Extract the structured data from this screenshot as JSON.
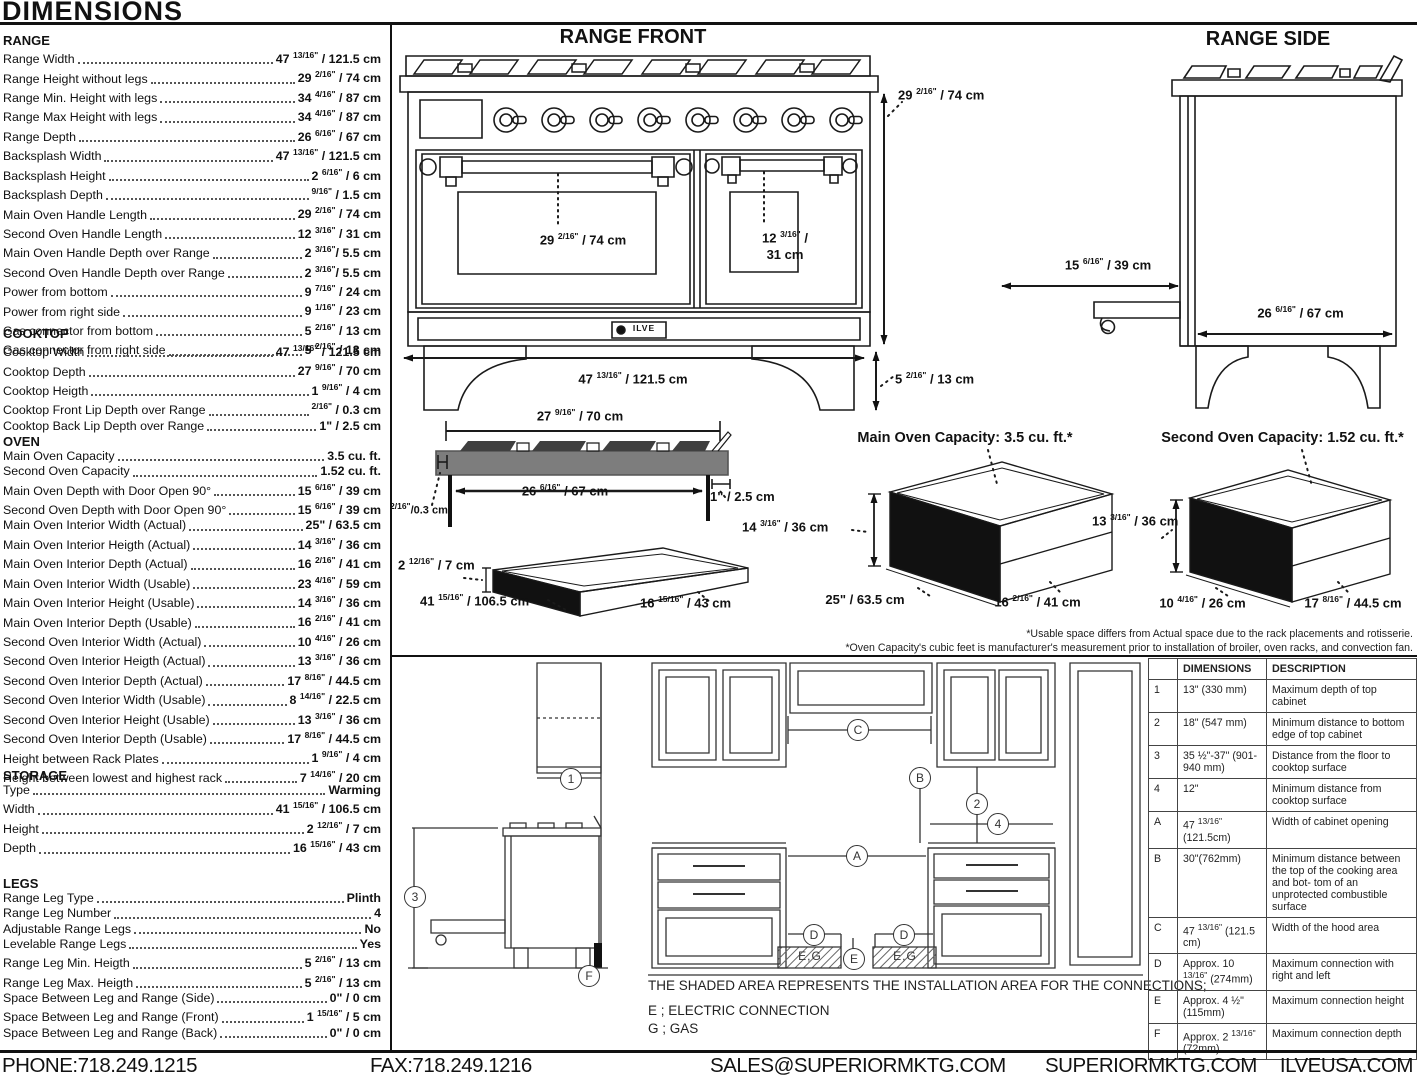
{
  "page": {
    "title": "DIMENSIONS",
    "footer": {
      "phone": "PHONE:718.249.1215",
      "fax": "FAX:718.249.1216",
      "email": "SALES@SUPERIORMKTG.COM",
      "site": "SUPERIORMKTG.COM",
      "brand_site": "ILVEUSA.COM"
    }
  },
  "specs": {
    "sections": [
      {
        "name": "RANGE",
        "rows": [
          {
            "label": "Range Width",
            "value": "47 13/16\" / 121.5 cm"
          },
          {
            "label": "Range Height without legs",
            "value": "29 2/16\" / 74 cm"
          },
          {
            "label": "Range Min. Height with legs",
            "value": "34 4/16\" / 87 cm"
          },
          {
            "label": "Range Max Height with legs",
            "value": "34 4/16\" / 87 cm"
          },
          {
            "label": "Range Depth",
            "value": "26 6/16\" / 67 cm"
          },
          {
            "label": "Backsplash Width",
            "value": "47 13/16\" / 121.5 cm"
          },
          {
            "label": "Backsplash Height",
            "value": "2 6/16\" / 6 cm"
          },
          {
            "label": "Backsplash Depth",
            "value": "9/16\" / 1.5 cm"
          },
          {
            "label": "Main Oven Handle Length",
            "value": "29 2/16\" / 74 cm"
          },
          {
            "label": "Second Oven Handle Length",
            "value": "12 3/16\" / 31 cm"
          },
          {
            "label": "Main Oven Handle Depth over Range",
            "value": "2 3/16\"/ 5.5 cm"
          },
          {
            "label": "Second Oven Handle Depth over Range",
            "value": "2 3/16\"/ 5.5 cm"
          },
          {
            "label": "Power from bottom",
            "value": "9 7/16\" / 24 cm"
          },
          {
            "label": "Power from right side",
            "value": "9 1/16\" / 23 cm"
          },
          {
            "label": "Gas connector from bottom",
            "value": "5 2/16\" / 13 cm"
          },
          {
            "label": "Gas connector from right side",
            "value": "5 2/16\" / 13 cm"
          }
        ]
      },
      {
        "name": "COOKTOP",
        "rows": [
          {
            "label": "Cooktop Width",
            "value": "47 13/16\" / 121.5 cm"
          },
          {
            "label": "Cooktop Depth",
            "value": "27 9/16\" / 70 cm"
          },
          {
            "label": "Cooktop Heigth",
            "value": "1 9/16\" / 4 cm"
          },
          {
            "label": "Cooktop Front Lip Depth over Range",
            "value": "2/16\" / 0.3 cm"
          },
          {
            "label": "Cooktop Back Lip Depth over Range",
            "value": "1\" / 2.5 cm"
          }
        ]
      },
      {
        "name": "OVEN",
        "rows": [
          {
            "label": "Main Oven Capacity",
            "value": "3.5 cu. ft."
          },
          {
            "label": "Second Oven Capacity",
            "value": "1.52 cu. ft."
          },
          {
            "label": "Main Oven Depth with Door Open 90°",
            "value": "15 6/16\" / 39 cm"
          },
          {
            "label": "Second Oven Depth with Door Open 90°",
            "value": "15 6/16\" / 39 cm"
          },
          {
            "label": "Main Oven Interior Width (Actual)",
            "value": "25\" / 63.5 cm"
          },
          {
            "label": "Main Oven Interior Heigth (Actual)",
            "value": "14 3/16\" / 36 cm"
          },
          {
            "label": "Main Oven Interior Depth (Actual)",
            "value": "16 2/16\" / 41 cm"
          },
          {
            "label": "Main Oven Interior Width (Usable)",
            "value": "23 4/16\" / 59 cm"
          },
          {
            "label": "Main Oven Interior Height (Usable)",
            "value": "14 3/16\" / 36 cm"
          },
          {
            "label": "Main Oven Interior Depth (Usable)",
            "value": "16 2/16\" / 41 cm"
          },
          {
            "label": "Second Oven Interior Width (Actual)",
            "value": "10 4/16\" / 26 cm"
          },
          {
            "label": "Second Oven Interior Heigth (Actual)",
            "value": "13 3/16\" / 36 cm"
          },
          {
            "label": "Second Oven Interior Depth (Actual)",
            "value": "17 8/16\" / 44.5 cm"
          },
          {
            "label": "Second Oven Interior Width (Usable)",
            "value": "8 14/16\" / 22.5 cm"
          },
          {
            "label": "Second Oven Interior Height (Usable)",
            "value": "13 3/16\" / 36 cm"
          },
          {
            "label": "Second Oven Interior Depth (Usable)",
            "value": "17 8/16\" / 44.5 cm"
          },
          {
            "label": "Height between Rack Plates",
            "value": "1 9/16\" / 4 cm"
          },
          {
            "label": "Height between lowest and highest rack",
            "value": "7 14/16\" / 20 cm"
          }
        ]
      },
      {
        "name": "STORAGE",
        "rows": [
          {
            "label": "Type",
            "value": "Warming"
          },
          {
            "label": "Width",
            "value": "41 15/16\" / 106.5 cm"
          },
          {
            "label": "Height",
            "value": "2 12/16\" / 7 cm"
          },
          {
            "label": "Depth",
            "value": "16 15/16\" / 43 cm"
          }
        ]
      },
      {
        "name": "LEGS",
        "rows": [
          {
            "label": "Range Leg Type",
            "value": "Plinth"
          },
          {
            "label": "Range Leg Number",
            "value": "4"
          },
          {
            "label": "Adjustable Range Legs",
            "value": "No"
          },
          {
            "label": "Levelable Range Legs",
            "value": "Yes"
          },
          {
            "label": "Range Leg Min. Heigth",
            "value": "5 2/16\" / 13 cm"
          },
          {
            "label": "Range Leg Max. Heigth",
            "value": "5 2/16\" / 13 cm"
          },
          {
            "label": "Space Between Leg and Range (Side)",
            "value": "0\" / 0 cm"
          },
          {
            "label": "Space Between Leg and Range (Front)",
            "value": "1 15/16\" / 5 cm"
          },
          {
            "label": "Space Between Leg and Range (Back)",
            "value": "0\" / 0 cm"
          }
        ]
      }
    ]
  },
  "diagrams": {
    "range_front": {
      "title": "RANGE FRONT",
      "logo": "ILVE",
      "labels": {
        "height": "29 2/16\" / 74 cm",
        "main_handle": "29 2/16\" / 74 cm",
        "second_handle_1": "12 3/16\" /",
        "second_handle_2": "31 cm",
        "width": "47 13/16\" / 121.5 cm",
        "leg_height": "5 2/16\" / 13 cm"
      }
    },
    "range_side": {
      "title": "RANGE SIDE",
      "labels": {
        "drawer_extension": "15 6/16\" / 39 cm",
        "depth": "26 6/16\" / 67 cm"
      }
    },
    "cooktop_profile": {
      "labels": {
        "width": "27 9/16\" / 70 cm",
        "inner_width": "26 6/16\" / 67 cm",
        "back_lip": "1\" / 2.5 cm",
        "front_lip": "2/16\"/0.3 cm"
      }
    },
    "storage_drawer": {
      "labels": {
        "height": "2 12/16\" / 7 cm",
        "width": "41 15/16\" / 106.5 cm",
        "depth": "16 15/16\" / 43 cm"
      }
    },
    "main_oven": {
      "title": "Main Oven Capacity: 3.5 cu. ft.*",
      "labels": {
        "height": "14 3/16\" / 36 cm",
        "width": "25\" / 63.5 cm",
        "depth": "16 2/16\" / 41 cm"
      }
    },
    "second_oven": {
      "title": "Second Oven Capacity: 1.52 cu. ft.*",
      "labels": {
        "height": "13 3/16\" / 36 cm",
        "width": "10 4/16\" / 26 cm",
        "depth": "17 8/16\" / 44.5 cm"
      }
    },
    "footnotes": [
      "*Usable space differs from Actual space due to the rack placements and rotisserie.",
      "*Oven Capacity's cubic feet is manufacturer's measurement prior to installation of broiler, oven racks, and convection fan."
    ]
  },
  "installation": {
    "note": "THE SHADED AREA REPRESENTS THE INSTALLATION AREA FOR THE CONNECTIONS;",
    "electric": "E ; ELECTRIC CONNECTION",
    "gas": "G ; GAS",
    "shaded_label": "E,G",
    "markers": {
      "one": "1",
      "two": "2",
      "three": "3",
      "four": "4",
      "a": "A",
      "b": "B",
      "c": "C",
      "d": "D",
      "e": "E",
      "f": "F"
    }
  },
  "table": {
    "headers": [
      "DIMENSIONS",
      "DESCRIPTION"
    ],
    "rows": [
      {
        "id": "1",
        "dimensions": "13\" (330 mm)",
        "description": "Maximum depth of top cabinet"
      },
      {
        "id": "2",
        "dimensions": "18\" (547 mm)",
        "description": "Minimum distance to bottom edge of top cabinet"
      },
      {
        "id": "3",
        "dimensions": "35 ½\"-37\" (901-940 mm)",
        "description": "Distance from the floor to cooktop surface"
      },
      {
        "id": "4",
        "dimensions": "12\"",
        "description": "Minimum distance from cooktop surface"
      },
      {
        "id": "A",
        "dimensions": "47 13/16\"(121.5cm)",
        "description": "Width of cabinet opening"
      },
      {
        "id": "B",
        "dimensions": "30\"(762mm)",
        "description": "Minimum distance between the top of the cooking area and bot- tom of an unprotected combustible surface"
      },
      {
        "id": "C",
        "dimensions": "47 13/16\" (121.5 cm)",
        "description": "Width of the hood area"
      },
      {
        "id": "D",
        "dimensions": "Approx. 10 13/16\" (274mm)",
        "description": "Maximum connection with right and left"
      },
      {
        "id": "E",
        "dimensions": "Approx. 4 ½\" (115mm)",
        "description": "Maximum connection height"
      },
      {
        "id": "F",
        "dimensions": "Approx. 2 13/16\" (72mm)",
        "description": "Maximum connection depth"
      }
    ]
  }
}
